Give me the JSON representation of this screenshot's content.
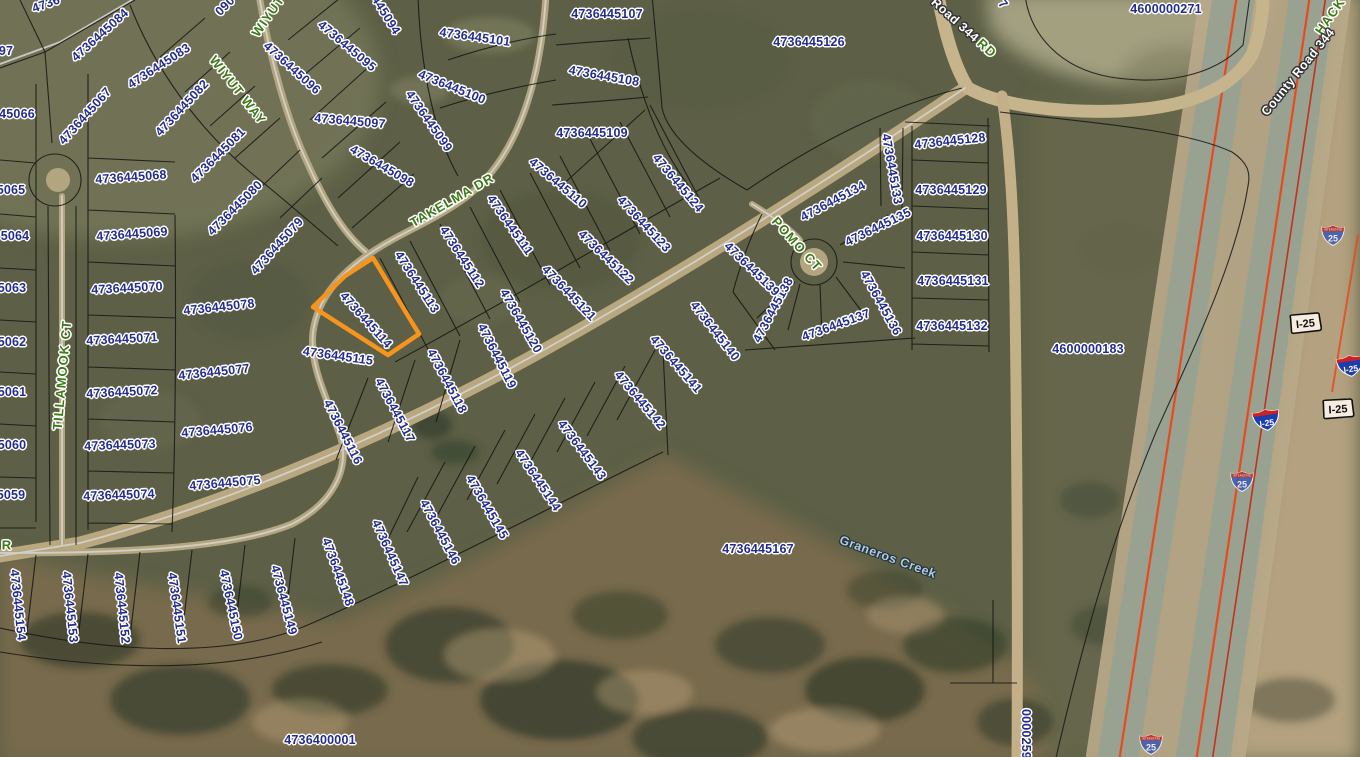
{
  "map": {
    "selected_parcel": {
      "id": "4736445114",
      "outline_color": "#F7941E"
    },
    "colors": {
      "parcel_text": "#232C8E",
      "street_text": "#3C7A16",
      "road_text": "#FFFFFF",
      "creek_text": "#AECBE0",
      "highlight": "#F7941E",
      "route_line": "#E8491F"
    },
    "parcel_labels": [
      {
        "text": "4736445084",
        "x": 100,
        "y": 35,
        "r": -42
      },
      {
        "text": "4736445083",
        "x": 159,
        "y": 66,
        "r": -33
      },
      {
        "text": "4736445082",
        "x": 182,
        "y": 108,
        "r": -47
      },
      {
        "text": "4736445081",
        "x": 218,
        "y": 155,
        "r": -45
      },
      {
        "text": "4736445080",
        "x": 235,
        "y": 208,
        "r": -45
      },
      {
        "text": "4736445079",
        "x": 277,
        "y": 246,
        "r": -48
      },
      {
        "text": "4736445078",
        "x": 219,
        "y": 307,
        "r": -6
      },
      {
        "text": "4736445077",
        "x": 214,
        "y": 372,
        "r": -6
      },
      {
        "text": "4736445076",
        "x": 217,
        "y": 430,
        "r": -5
      },
      {
        "text": "4736445075",
        "x": 225,
        "y": 483,
        "r": -5
      },
      {
        "text": "4736445074",
        "x": 119,
        "y": 495,
        "r": -2
      },
      {
        "text": "4736445073",
        "x": 120,
        "y": 445,
        "r": -2
      },
      {
        "text": "4736445072",
        "x": 122,
        "y": 392,
        "r": -3
      },
      {
        "text": "4736445071",
        "x": 122,
        "y": 339,
        "r": -3
      },
      {
        "text": "4736445070",
        "x": 127,
        "y": 288,
        "r": -3
      },
      {
        "text": "4736445069",
        "x": 132,
        "y": 234,
        "r": -4
      },
      {
        "text": "4736445068",
        "x": 131,
        "y": 177,
        "r": -4
      },
      {
        "text": "4736445067",
        "x": 85,
        "y": 116,
        "r": -48
      },
      {
        "text": "45066",
        "x": 17,
        "y": 114,
        "r": 0
      },
      {
        "text": "97",
        "x": 6,
        "y": 51,
        "r": 0
      },
      {
        "text": "4736",
        "x": 46,
        "y": 4,
        "r": -20
      },
      {
        "text": "090",
        "x": 225,
        "y": 6,
        "r": -45
      },
      {
        "text": "5065",
        "x": 11,
        "y": 190,
        "r": 0
      },
      {
        "text": "5064",
        "x": 15,
        "y": 236,
        "r": 0
      },
      {
        "text": "5063",
        "x": 12,
        "y": 288,
        "r": 0
      },
      {
        "text": "5062",
        "x": 12,
        "y": 342,
        "r": 0
      },
      {
        "text": "5061",
        "x": 12,
        "y": 392,
        "r": 0
      },
      {
        "text": "5060",
        "x": 12,
        "y": 445,
        "r": 0
      },
      {
        "text": "5059",
        "x": 11,
        "y": 495,
        "r": 0
      },
      {
        "text": "4736445096",
        "x": 292,
        "y": 68,
        "r": 42
      },
      {
        "text": "4736445095",
        "x": 347,
        "y": 46,
        "r": 40
      },
      {
        "text": "445094",
        "x": 386,
        "y": 15,
        "r": 58
      },
      {
        "text": "4736445097",
        "x": 350,
        "y": 121,
        "r": 5
      },
      {
        "text": "4736445098",
        "x": 382,
        "y": 166,
        "r": 30
      },
      {
        "text": "4736445099",
        "x": 429,
        "y": 121,
        "r": 55
      },
      {
        "text": "4736445100",
        "x": 452,
        "y": 87,
        "r": 22
      },
      {
        "text": "4736445101",
        "x": 475,
        "y": 37,
        "r": 8
      },
      {
        "text": "4736445107",
        "x": 607,
        "y": 14,
        "r": 0
      },
      {
        "text": "4736445108",
        "x": 604,
        "y": 76,
        "r": 10
      },
      {
        "text": "4736445109",
        "x": 592,
        "y": 133,
        "r": 0
      },
      {
        "text": "4736445110",
        "x": 558,
        "y": 183,
        "r": 40
      },
      {
        "text": "4736445111",
        "x": 510,
        "y": 225,
        "r": 55
      },
      {
        "text": "4736445112",
        "x": 462,
        "y": 257,
        "r": 57
      },
      {
        "text": "4736445113",
        "x": 417,
        "y": 282,
        "r": 57
      },
      {
        "text": "4736445114",
        "x": 366,
        "y": 320,
        "r": 48
      },
      {
        "text": "4736445115",
        "x": 338,
        "y": 356,
        "r": 8
      },
      {
        "text": "4736445116",
        "x": 343,
        "y": 432,
        "r": 63
      },
      {
        "text": "4736445117",
        "x": 395,
        "y": 410,
        "r": 62
      },
      {
        "text": "4736445118",
        "x": 447,
        "y": 381,
        "r": 62
      },
      {
        "text": "4736445119",
        "x": 497,
        "y": 356,
        "r": 63
      },
      {
        "text": "4736445120",
        "x": 521,
        "y": 321,
        "r": 60
      },
      {
        "text": "4736445121",
        "x": 569,
        "y": 293,
        "r": 46
      },
      {
        "text": "4736445122",
        "x": 606,
        "y": 257,
        "r": 44
      },
      {
        "text": "4736445123",
        "x": 644,
        "y": 224,
        "r": 47
      },
      {
        "text": "4736445124",
        "x": 678,
        "y": 183,
        "r": 50
      },
      {
        "text": "4736445126",
        "x": 809,
        "y": 42,
        "r": 0
      },
      {
        "text": "4600000271",
        "x": 1166,
        "y": 9,
        "r": 0
      },
      {
        "text": "7",
        "x": 1003,
        "y": 4,
        "r": 50
      },
      {
        "text": "4736445128",
        "x": 950,
        "y": 141,
        "r": -6
      },
      {
        "text": "4736445129",
        "x": 951,
        "y": 190,
        "r": 0
      },
      {
        "text": "4736445130",
        "x": 952,
        "y": 236,
        "r": 0
      },
      {
        "text": "4736445131",
        "x": 953,
        "y": 281,
        "r": 0
      },
      {
        "text": "4736445132",
        "x": 952,
        "y": 326,
        "r": 0
      },
      {
        "text": "4736445133",
        "x": 892,
        "y": 169,
        "r": 80
      },
      {
        "text": "4736445134",
        "x": 833,
        "y": 201,
        "r": -28
      },
      {
        "text": "4736445135",
        "x": 878,
        "y": 227,
        "r": -26
      },
      {
        "text": "4736445136",
        "x": 881,
        "y": 303,
        "r": 61
      },
      {
        "text": "4736445137",
        "x": 836,
        "y": 325,
        "r": -20
      },
      {
        "text": "4736445138",
        "x": 773,
        "y": 310,
        "r": -62
      },
      {
        "text": "4736445139",
        "x": 752,
        "y": 269,
        "r": 44
      },
      {
        "text": "4736445140",
        "x": 715,
        "y": 331,
        "r": 52
      },
      {
        "text": "4736445141",
        "x": 676,
        "y": 364,
        "r": 49
      },
      {
        "text": "4736445142",
        "x": 640,
        "y": 400,
        "r": 50
      },
      {
        "text": "4736445143",
        "x": 582,
        "y": 450,
        "r": 53
      },
      {
        "text": "4736445144",
        "x": 538,
        "y": 480,
        "r": 56
      },
      {
        "text": "4736445145",
        "x": 487,
        "y": 507,
        "r": 60
      },
      {
        "text": "4736445146",
        "x": 440,
        "y": 532,
        "r": 62
      },
      {
        "text": "4736445147",
        "x": 390,
        "y": 553,
        "r": 66
      },
      {
        "text": "4736445148",
        "x": 338,
        "y": 572,
        "r": 70
      },
      {
        "text": "4736445149",
        "x": 284,
        "y": 600,
        "r": 75
      },
      {
        "text": "4736445150",
        "x": 231,
        "y": 605,
        "r": 78
      },
      {
        "text": "4736445151",
        "x": 177,
        "y": 608,
        "r": 82
      },
      {
        "text": "4736445152",
        "x": 122,
        "y": 608,
        "r": 84
      },
      {
        "text": "4736445153",
        "x": 70,
        "y": 607,
        "r": 84
      },
      {
        "text": "4736445154",
        "x": 18,
        "y": 605,
        "r": 84
      },
      {
        "text": "4736445167",
        "x": 758,
        "y": 549,
        "r": 0
      },
      {
        "text": "4600000183",
        "x": 1088,
        "y": 349,
        "r": 0
      },
      {
        "text": "4736400001",
        "x": 320,
        "y": 740,
        "r": 0
      },
      {
        "text": "0000259",
        "x": 1026,
        "y": 734,
        "r": 90
      }
    ],
    "street_labels": [
      {
        "text": "WIYUT WAY",
        "x": 238,
        "y": 90,
        "r": 52
      },
      {
        "text": "WIYUT",
        "x": 268,
        "y": 16,
        "r": -55
      },
      {
        "text": "TAKELMA DR",
        "x": 452,
        "y": 200,
        "r": -30
      },
      {
        "text": "TILLAMOOK CT",
        "x": 62,
        "y": 375,
        "r": -85
      },
      {
        "text": "POMO CT",
        "x": 797,
        "y": 244,
        "r": 48
      },
      {
        "text": "RD",
        "x": 987,
        "y": 48,
        "r": 42
      },
      {
        "text": "R",
        "x": 7,
        "y": 545,
        "r": 0
      },
      {
        "text": "HACK",
        "x": 1330,
        "y": 16,
        "r": -55
      }
    ],
    "road_labels": [
      {
        "text": "Road 344",
        "x": 955,
        "y": 20,
        "r": 42
      },
      {
        "text": "County Road 344",
        "x": 1298,
        "y": 72,
        "r": -51
      }
    ],
    "creek_labels": [
      {
        "text": "Graneros Creek",
        "x": 888,
        "y": 557,
        "r": 20
      }
    ],
    "highway_shields": [
      {
        "type": "interstate",
        "text": "25",
        "x": 1321,
        "y": 225,
        "r": 0
      },
      {
        "type": "interstate",
        "text": "25",
        "x": 1230,
        "y": 471,
        "r": 0
      },
      {
        "type": "interstate",
        "text": "25",
        "x": 1139,
        "y": 734,
        "r": 0
      },
      {
        "type": "badge",
        "text": "I-25",
        "x": 1286,
        "y": 313,
        "r": -6
      },
      {
        "type": "badge",
        "text": "I-25",
        "x": 1319,
        "y": 398,
        "r": -4
      },
      {
        "type": "blueshield",
        "text": "I-25",
        "x": 1335,
        "y": 357,
        "r": -8
      },
      {
        "type": "blueshield",
        "text": "I-25",
        "x": 1251,
        "y": 411,
        "r": -8
      }
    ]
  }
}
